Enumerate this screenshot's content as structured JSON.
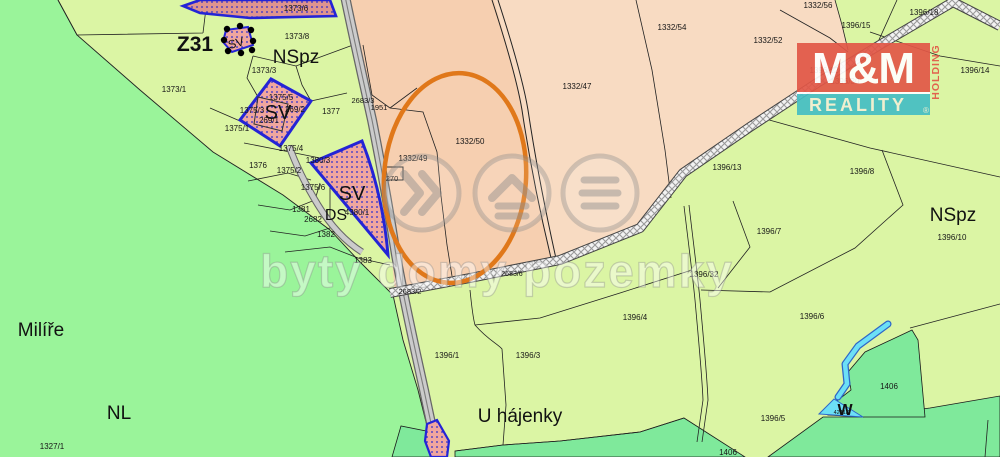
{
  "watermark": {
    "text": "byty domy pozemky"
  },
  "logo": {
    "mm": "M&M",
    "reality": "REALITY",
    "holding": "HOLDING",
    "registered": "®"
  },
  "highlight": {
    "label": "Z31",
    "color": "#C800C8"
  },
  "colors": {
    "bright_green": "#9AF49A",
    "pale_green": "#DBF5A4",
    "dark_green": "#7FE99B",
    "salmon_light": "#F8DBC2",
    "salmon_dark": "#F6CFB0",
    "sv_pink": "#F0A69E",
    "sv_pink_dark": "#DE948E",
    "sv_border": "#2424D6",
    "road_gray": "#CBCBCB",
    "stream_cyan": "#6CE0F6",
    "highlight_orange": "#E0781A",
    "logo_red": "#E25747",
    "logo_teal": "#45BEC4"
  },
  "zones": [
    {
      "text": "NSpz",
      "x": 296,
      "y": 63,
      "size": 19
    },
    {
      "text": "NSpz",
      "x": 953,
      "y": 221,
      "size": 19
    },
    {
      "text": "Milíře",
      "x": 41,
      "y": 336,
      "size": 19
    },
    {
      "text": "NL",
      "x": 119,
      "y": 419,
      "size": 19
    },
    {
      "text": "U hájenky",
      "x": 520,
      "y": 422,
      "size": 19
    },
    {
      "text": "SV",
      "x": 278,
      "y": 119,
      "size": 20
    },
    {
      "text": "SV",
      "x": 352,
      "y": 200,
      "size": 20
    },
    {
      "text": "SV",
      "x": 237,
      "y": 47,
      "size": 12,
      "rotate": -15
    },
    {
      "text": "DS",
      "x": 336,
      "y": 220,
      "size": 16
    },
    {
      "text": "W",
      "x": 845,
      "y": 415,
      "size": 16,
      "bold": true
    },
    {
      "text": "Z31",
      "x": 195,
      "y": 51,
      "size": 21,
      "color": "#C800C8",
      "bold": true
    }
  ],
  "parcels": [
    {
      "text": "1373/6",
      "x": 296,
      "y": 11
    },
    {
      "text": "1373/8",
      "x": 297,
      "y": 39
    },
    {
      "text": "1373/3",
      "x": 264,
      "y": 73
    },
    {
      "text": "1373/1",
      "x": 174,
      "y": 92
    },
    {
      "text": "1375/1",
      "x": 237,
      "y": 131
    },
    {
      "text": "1375/5",
      "x": 281,
      "y": 100
    },
    {
      "text": "1375/3",
      "x": 252,
      "y": 113
    },
    {
      "text": "269/1",
      "x": 269,
      "y": 123
    },
    {
      "text": "269/2",
      "x": 295,
      "y": 112
    },
    {
      "text": "1377",
      "x": 331,
      "y": 114
    },
    {
      "text": "1375/4",
      "x": 291,
      "y": 151
    },
    {
      "text": "1380/3",
      "x": 318,
      "y": 163
    },
    {
      "text": "1376",
      "x": 258,
      "y": 168
    },
    {
      "text": "1375/2",
      "x": 289,
      "y": 173
    },
    {
      "text": "1375/6",
      "x": 313,
      "y": 190
    },
    {
      "text": "270",
      "x": 392,
      "y": 181,
      "size": 7.5
    },
    {
      "text": "1381",
      "x": 301,
      "y": 212
    },
    {
      "text": "2682",
      "x": 313,
      "y": 222
    },
    {
      "text": "1382",
      "x": 326,
      "y": 237
    },
    {
      "text": "4380/1",
      "x": 357,
      "y": 215
    },
    {
      "text": "1383",
      "x": 363,
      "y": 263
    },
    {
      "text": "2683/3",
      "x": 363,
      "y": 103,
      "size": 7.5
    },
    {
      "text": "1951",
      "x": 379,
      "y": 110,
      "size": 7.5
    },
    {
      "text": "1332/49",
      "x": 413,
      "y": 161
    },
    {
      "text": "1332/50",
      "x": 470,
      "y": 144
    },
    {
      "text": "1332/47",
      "x": 577,
      "y": 89
    },
    {
      "text": "1332/54",
      "x": 672,
      "y": 30
    },
    {
      "text": "1332/52",
      "x": 768,
      "y": 43
    },
    {
      "text": "1332/56",
      "x": 818,
      "y": 8
    },
    {
      "text": "1396/18",
      "x": 924,
      "y": 15
    },
    {
      "text": "1396/15",
      "x": 856,
      "y": 28
    },
    {
      "text": "1396/14",
      "x": 975,
      "y": 73
    },
    {
      "text": "1396/12",
      "x": 824,
      "y": 73
    },
    {
      "text": "1396/30",
      "x": 845,
      "y": 84
    },
    {
      "text": "1396/13",
      "x": 727,
      "y": 170
    },
    {
      "text": "1396/8",
      "x": 862,
      "y": 174
    },
    {
      "text": "1396/7",
      "x": 769,
      "y": 234
    },
    {
      "text": "1396/10",
      "x": 952,
      "y": 240
    },
    {
      "text": "1396/32",
      "x": 704,
      "y": 277
    },
    {
      "text": "1396/6",
      "x": 812,
      "y": 319
    },
    {
      "text": "1406",
      "x": 889,
      "y": 389
    },
    {
      "text": "1396/4",
      "x": 635,
      "y": 320
    },
    {
      "text": "1396/1",
      "x": 447,
      "y": 358
    },
    {
      "text": "1396/3",
      "x": 528,
      "y": 358
    },
    {
      "text": "1396/5",
      "x": 773,
      "y": 421
    },
    {
      "text": "1406",
      "x": 728,
      "y": 455
    },
    {
      "text": "1327/1",
      "x": 52,
      "y": 449
    },
    {
      "text": "2683/2",
      "x": 410,
      "y": 294,
      "size": 7.5
    },
    {
      "text": "2683/6",
      "x": 512,
      "y": 276,
      "size": 7
    },
    {
      "text": "4241/1",
      "x": 842,
      "y": 414,
      "size": 5.5
    }
  ]
}
